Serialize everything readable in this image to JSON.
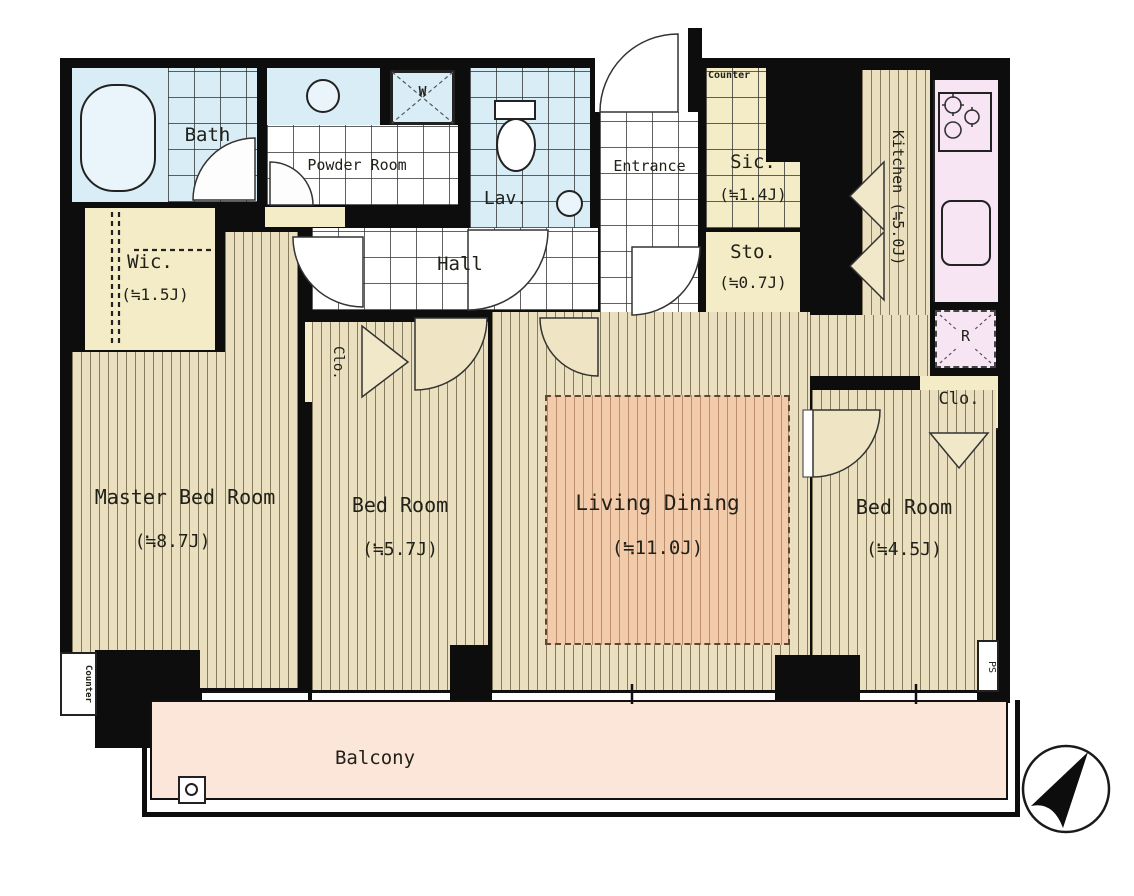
{
  "plan": {
    "title": "apartment-floor-plan",
    "rooms": {
      "bath": {
        "label": "Bath"
      },
      "powder_room": {
        "label": "Powder Room"
      },
      "lavatory": {
        "label": "Lav."
      },
      "entrance": {
        "label": "Entrance"
      },
      "hall": {
        "label": "Hall"
      },
      "shoes_in_closet": {
        "label": "Sic.",
        "area": "(≒1.4J)",
        "counter_label": "Counter"
      },
      "storage": {
        "label": "Sto.",
        "area": "(≒0.7J)"
      },
      "kitchen": {
        "label": "Kitchen (≒5.0J)"
      },
      "walk_in_closet": {
        "label": "Wic.",
        "area": "(≒1.5J)"
      },
      "closet_middle": {
        "label": "Clo."
      },
      "closet_right": {
        "label": "Clo."
      },
      "master_bedroom": {
        "label": "Master Bed Room",
        "area": "(≒8.7J)"
      },
      "bedroom_2": {
        "label": "Bed Room",
        "area": "(≒5.7J)"
      },
      "living_dining": {
        "label": "Living Dining",
        "area": "(≒11.0J)"
      },
      "bedroom_3": {
        "label": "Bed Room",
        "area": "(≒4.5J)"
      },
      "balcony": {
        "label": "Balcony"
      }
    },
    "fixtures": {
      "washing_machine": "W",
      "refrigerator": "R",
      "pipe_space": "PS",
      "counter_bottom": "Counter"
    },
    "colors": {
      "wall": "#0d0d0d",
      "wet_area_blue": "#d9edf7",
      "closet_cream": "#f4ecc6",
      "wood_floor": "#eae0bf",
      "living_rug": "#f2cbaa",
      "kitchen_pink": "#f8e5f4",
      "balcony_peach": "#fbe6d9"
    },
    "compass": {
      "direction": "north-east"
    }
  }
}
